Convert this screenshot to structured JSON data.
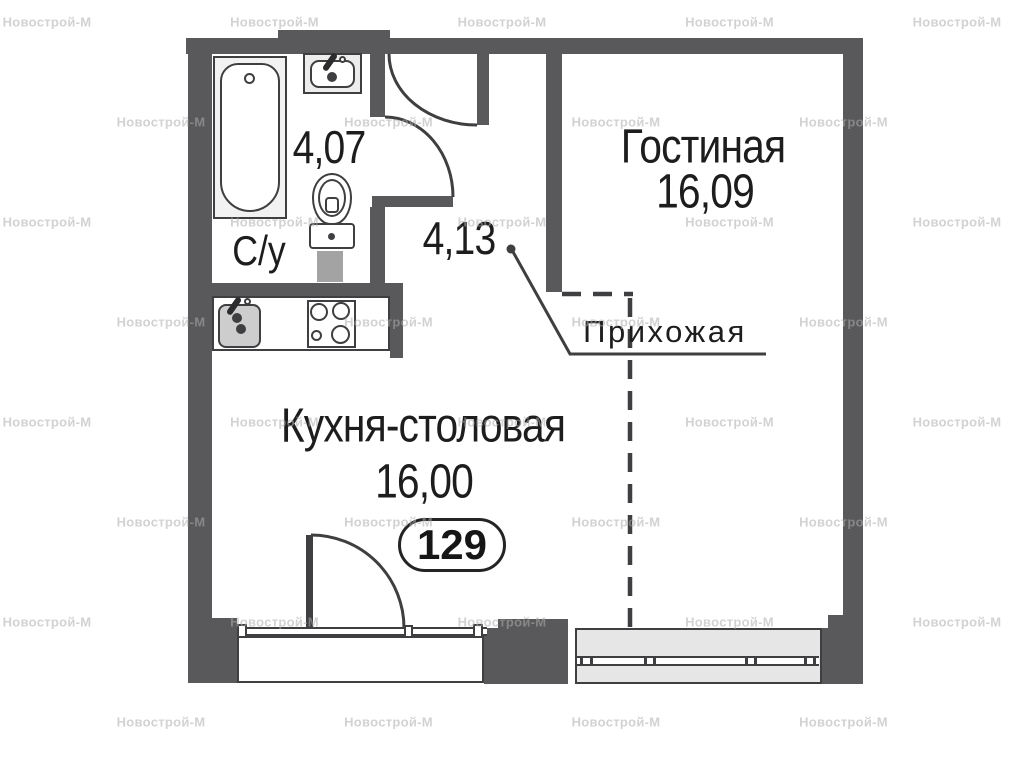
{
  "apartment_number": "129",
  "watermark": {
    "text": "Новострой-М"
  },
  "rooms": {
    "living": {
      "name": "Гостиная",
      "area": "16,09"
    },
    "kitchen": {
      "name": "Кухня-столовая",
      "area": "16,00"
    },
    "bathroom": {
      "name": "С/у",
      "area": "4,07"
    },
    "hallway": {
      "name": "Прихожая",
      "area": "4,13"
    }
  },
  "colors": {
    "wall": "#59595b",
    "line": "#3f3f41",
    "text": "#1d1d1d",
    "window_fill": "#e6e6e6",
    "fixture_fill": "#cdcdcd",
    "pedestal": "#a3a3a3"
  }
}
